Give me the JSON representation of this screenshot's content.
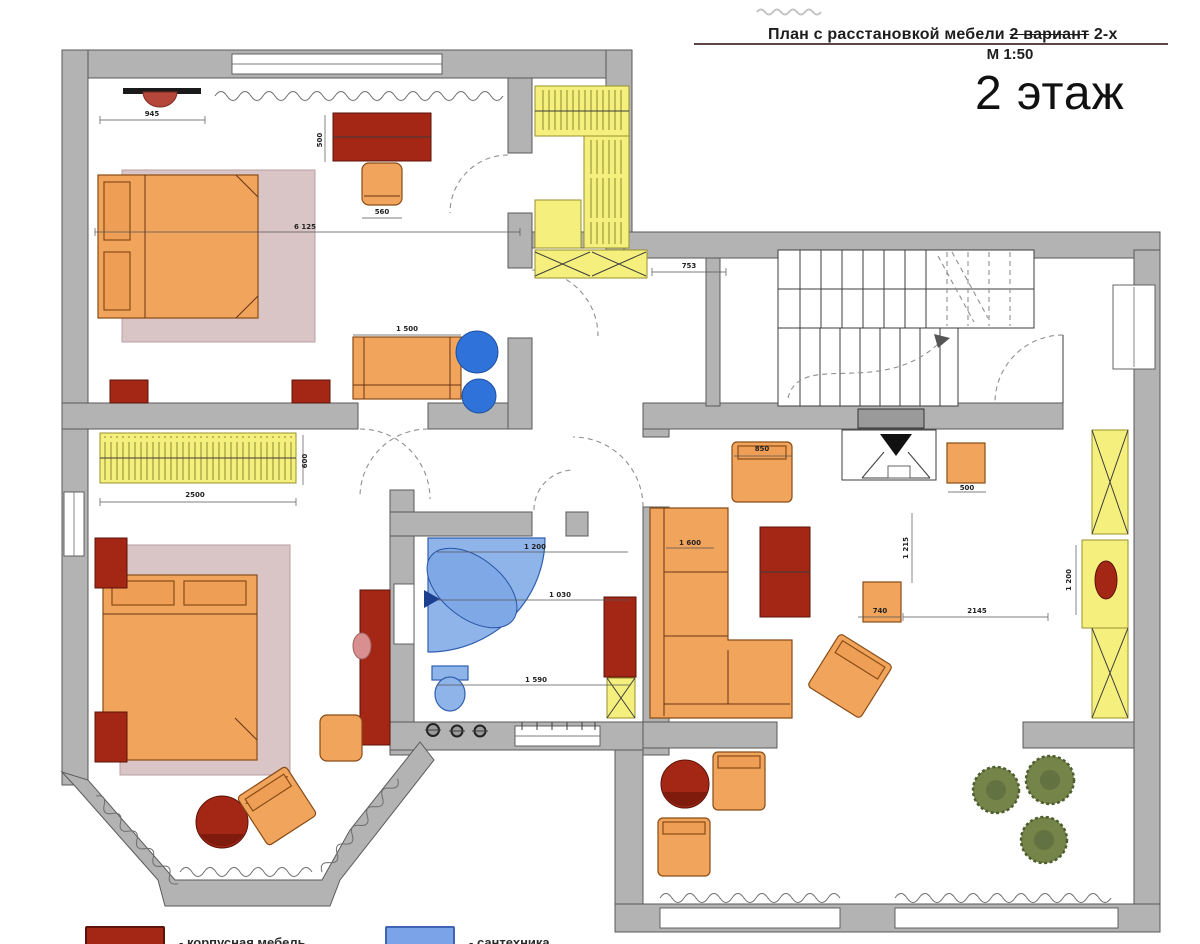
{
  "header": {
    "title_prefix": "План с расстановкой мебели ",
    "title_struck": "2 вариант",
    "title_suffix": " 2-х",
    "scale": "М 1:50",
    "floor_label": "2 этаж"
  },
  "legend": {
    "items": [
      {
        "label": "- корпусная мебель",
        "swatch": "#a32714",
        "swatch_border": "#5c130a"
      },
      {
        "label": "- сантехника",
        "swatch": "#7ba3e8",
        "swatch_border": "#3f63b5"
      }
    ]
  },
  "colors": {
    "wall": "#b3b3b3",
    "soft_furniture": "#f0a45c",
    "case_furniture": "#a32714",
    "storage": "#f5f07d",
    "sanitary_fill": "#8fb4ea",
    "sanitary_solid": "#2f72d9",
    "rug": "#d9c2c4",
    "plants": "#75854a"
  },
  "dimensions": [
    {
      "text": "945",
      "x": 152,
      "y": 116,
      "rot": 0
    },
    {
      "text": "6 125",
      "x": 305,
      "y": 229,
      "rot": 0
    },
    {
      "text": "500",
      "x": 322,
      "y": 140,
      "rot": -90
    },
    {
      "text": "560",
      "x": 382,
      "y": 214,
      "rot": 0
    },
    {
      "text": "1 500",
      "x": 407,
      "y": 331,
      "rot": 0
    },
    {
      "text": "753",
      "x": 689,
      "y": 268,
      "rot": 0
    },
    {
      "text": "2500",
      "x": 195,
      "y": 497,
      "rot": 0
    },
    {
      "text": "600",
      "x": 307,
      "y": 461,
      "rot": -90
    },
    {
      "text": "1 200",
      "x": 535,
      "y": 549,
      "rot": 0
    },
    {
      "text": "1 030",
      "x": 560,
      "y": 597,
      "rot": 0
    },
    {
      "text": "1 590",
      "x": 536,
      "y": 682,
      "rot": 0
    },
    {
      "text": "850",
      "x": 762,
      "y": 451,
      "rot": 0
    },
    {
      "text": "1 600",
      "x": 690,
      "y": 545,
      "rot": 0
    },
    {
      "text": "500",
      "x": 967,
      "y": 490,
      "rot": 0
    },
    {
      "text": "740",
      "x": 880,
      "y": 613,
      "rot": 0
    },
    {
      "text": "2145",
      "x": 977,
      "y": 613,
      "rot": 0
    },
    {
      "text": "1 215",
      "x": 908,
      "y": 548,
      "rot": -90
    },
    {
      "text": "1 200",
      "x": 1071,
      "y": 580,
      "rot": -90
    }
  ]
}
